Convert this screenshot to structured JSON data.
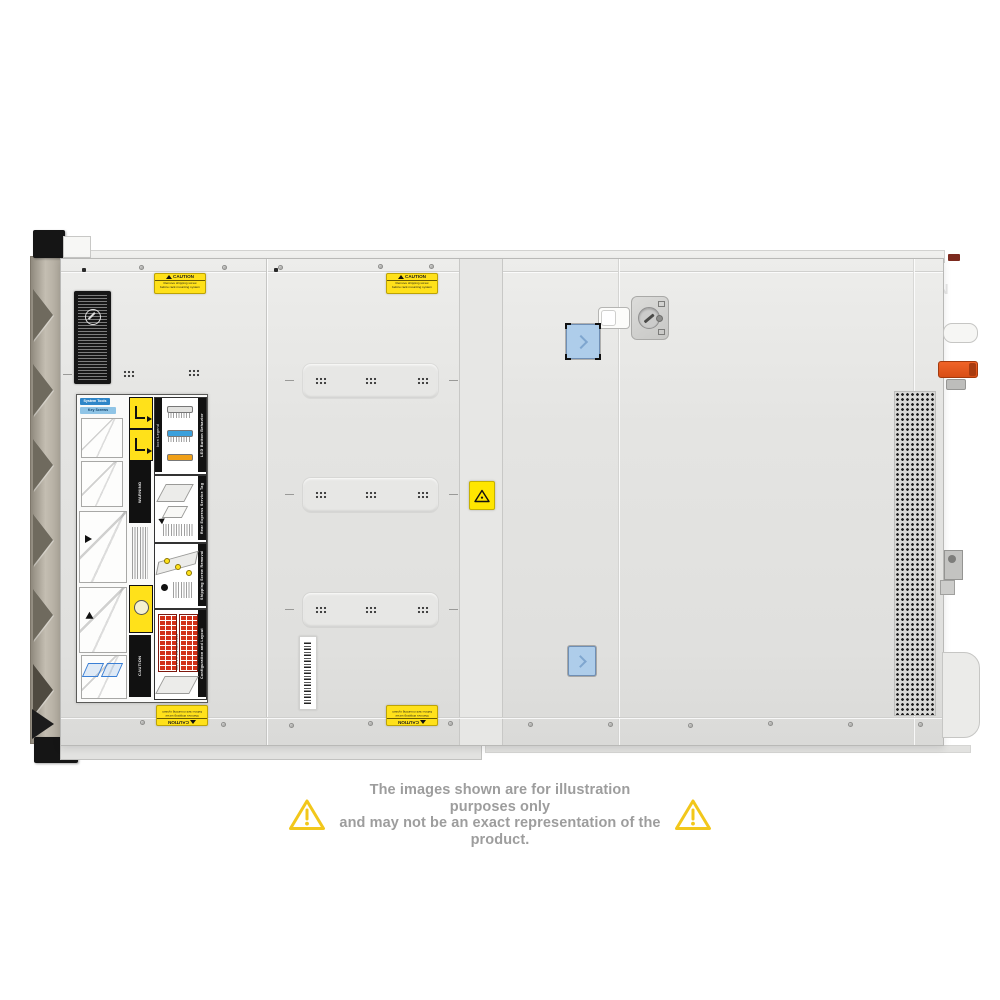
{
  "page": {
    "background": "#ffffff"
  },
  "watermark": {
    "text": "COMPAN",
    "logo_letter": "G"
  },
  "disclaimer": {
    "line1": "The images shown are for illustration purposes only",
    "line2": "and may not be an exact representation of the product.",
    "text_color": "#9d9d9d",
    "triangle_color": "#f2c71b"
  },
  "server": {
    "description": "Rack server chassis, top cover view, front bezel at left, rear handles at right",
    "colors": {
      "cover_gray": "#e4e4e2",
      "front_bezel_tan": "#b4ada1",
      "caution_yellow": "#ffe11a",
      "latch_blue": "#aecdea",
      "rear_handle_orange": "#e8581e",
      "drive_grid_red": "#d23018",
      "led_blue": "#3aa0dc",
      "led_amber": "#f0a018"
    },
    "caution_label": {
      "title": "CAUTION",
      "line1": "Remove shipping screw",
      "line2": "before rack mounting system"
    },
    "service_panel": {
      "system_tools": "System Tools",
      "key_screws": "Key Screws Identifier",
      "icon_legend": "Icon Legend",
      "led_button_behavior": "LED Button Behavior",
      "rear_express_service_tag": "Rear Express Service Tag",
      "shipping_screw_removal": "Shipping Screw Removal",
      "configuration_and_layout": "Configuration and Layout",
      "warning": "WARNING",
      "caution": "CAUTION",
      "bay1": "Bay 1 3.5\" x12 Hard Drives",
      "bay2": "Bay 2 3.5\" x12 Hard Drives"
    }
  }
}
